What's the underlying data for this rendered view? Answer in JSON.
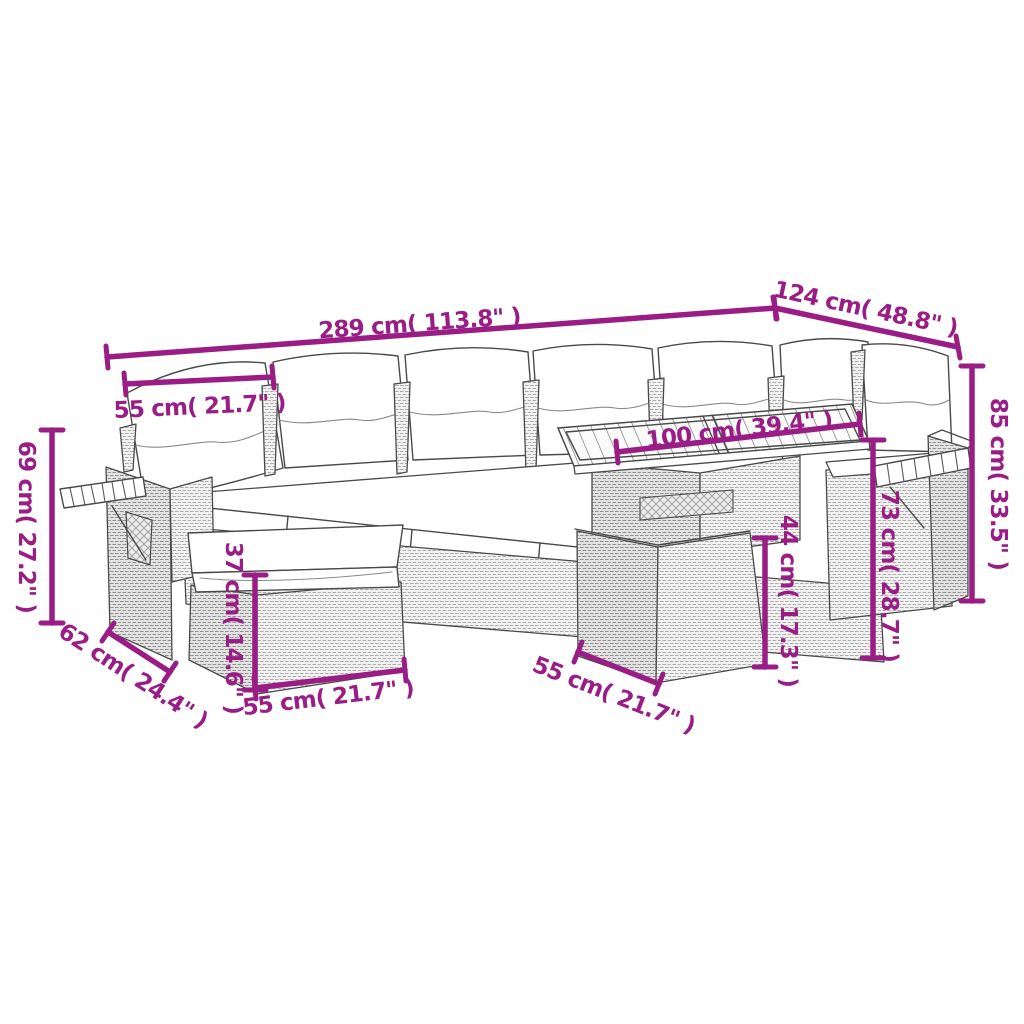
{
  "diagram": {
    "background_color": "#ffffff",
    "dimension_color": "#9A1D85",
    "line_art_color": "#4a4a4a",
    "dimensions": {
      "overall_width": "289 cm( 113.8\" )",
      "corner_return_width": "124 cm( 48.8\" )",
      "backrest_cushion_width": "55 cm( 21.7\" )",
      "table_top_length": "100 cm( 39.4\" )",
      "total_height": "85 cm( 33.5\" )",
      "side_section_height": "73 cm( 28.7\" )",
      "table_base_height": "44 cm( 17.3\" )",
      "footstool_height": "37 cm( 14.6\" )",
      "left_arm_height": "69 cm( 27.2\" )",
      "footstool_depth": "62 cm( 24.4\" )",
      "footstool_width": "55 cm( 21.7\" )",
      "table_depth": "55 cm( 21.7\" )"
    }
  }
}
